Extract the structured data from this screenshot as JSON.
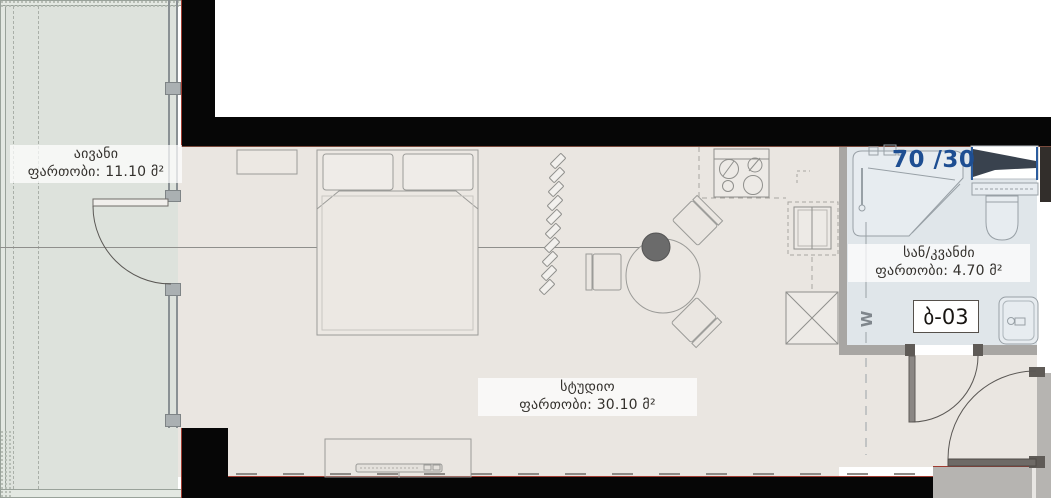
{
  "unit": {
    "number": "ბ-03",
    "shower_dimensions": "70 /30",
    "washer_mark": "W"
  },
  "rooms": {
    "balcony": {
      "name": "აივანი",
      "area_label": "ფართობი: 11.10 მ²"
    },
    "studio": {
      "name": "სტუდიო",
      "area_label": "ფართობი: 30.10 მ²"
    },
    "bathroom": {
      "name": "სან/კვანძი",
      "area_label": "ფართობი: 4.70 მ²"
    }
  },
  "colors": {
    "balcony_floor": "#dde2dc",
    "studio_floor": "#eae6e1",
    "bathroom_floor": "#e0e6ea",
    "wall_black": "#060606",
    "wall_gray": "#a8a6a3",
    "wall_light_gray": "#b6b4b1",
    "accent_red": "#a03b30",
    "label_blue": "#1e4e92",
    "line": "#9b9b98"
  }
}
